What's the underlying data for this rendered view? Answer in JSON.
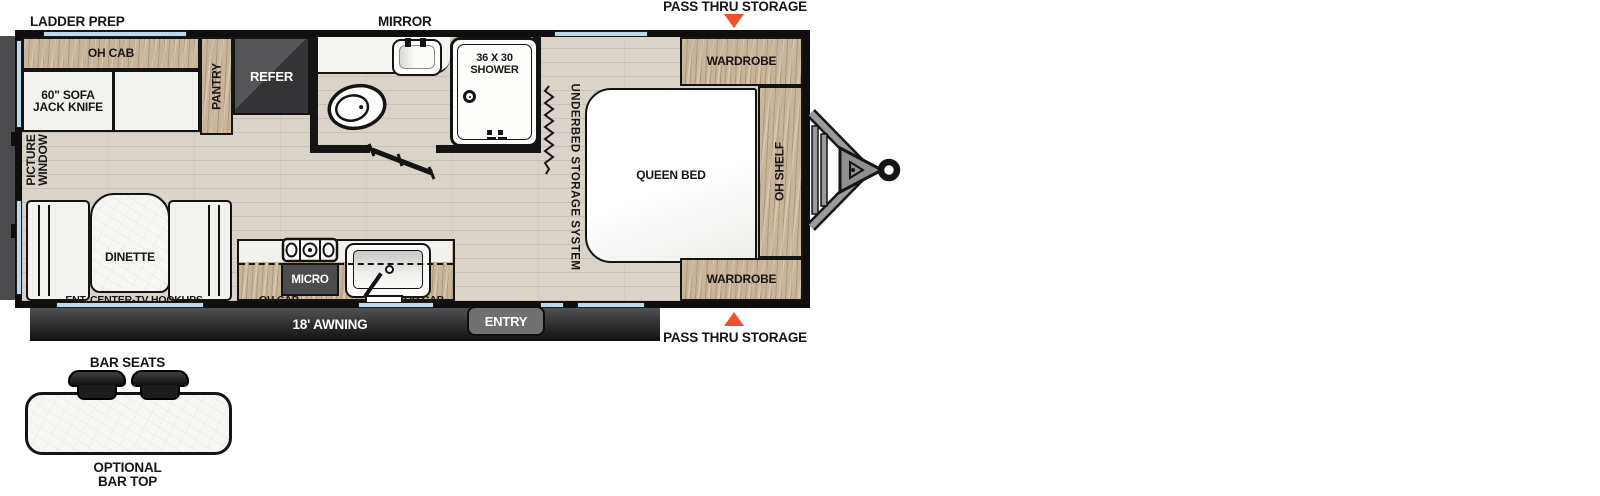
{
  "title": "Travel trailer floor plan",
  "exterior": {
    "ladder_prep": "LADDER PREP",
    "mirror": "MIRROR",
    "pass_thru_top": "PASS THRU STORAGE",
    "pass_thru_bottom": "PASS THRU STORAGE",
    "awning": "18' AWNING",
    "entry": "ENTRY"
  },
  "bar_option": {
    "bar_seats": "BAR SEATS",
    "optional_line1": "OPTIONAL",
    "optional_line2": "BAR TOP"
  },
  "living": {
    "oh_cab": "OH CAB",
    "sofa_line1": "60\" SOFA",
    "sofa_line2": "JACK KNIFE",
    "pantry": "PANTRY",
    "refer": "REFER",
    "picture_window_line1": "PICTURE",
    "picture_window_line2": "WINDOW",
    "dinette": "DINETTE",
    "ent_center": "ENT. CENTER-TV HOOKUPS"
  },
  "kitchen": {
    "micro": "MICRO",
    "oh_cab_left": "OH CAB",
    "oh_cab_right": "OH CAB"
  },
  "bath": {
    "shower_line1": "36 X 30",
    "shower_line2": "SHOWER"
  },
  "bedroom": {
    "underbed": "UNDERBED STORAGE SYSTEM",
    "queen_bed": "QUEEN BED",
    "wardrobe_top": "WARDROBE",
    "wardrobe_bottom": "WARDROBE",
    "oh_shelf": "OH SHELF"
  },
  "colors": {
    "wall": "#141414",
    "wood": "#c8b498",
    "floor": "#d9d3c9",
    "dark_appliance": "#4c4c4e",
    "awning_bar": "#2e2e30",
    "accent_orange": "#f1512a",
    "window_blue": "#bdd8e8"
  }
}
